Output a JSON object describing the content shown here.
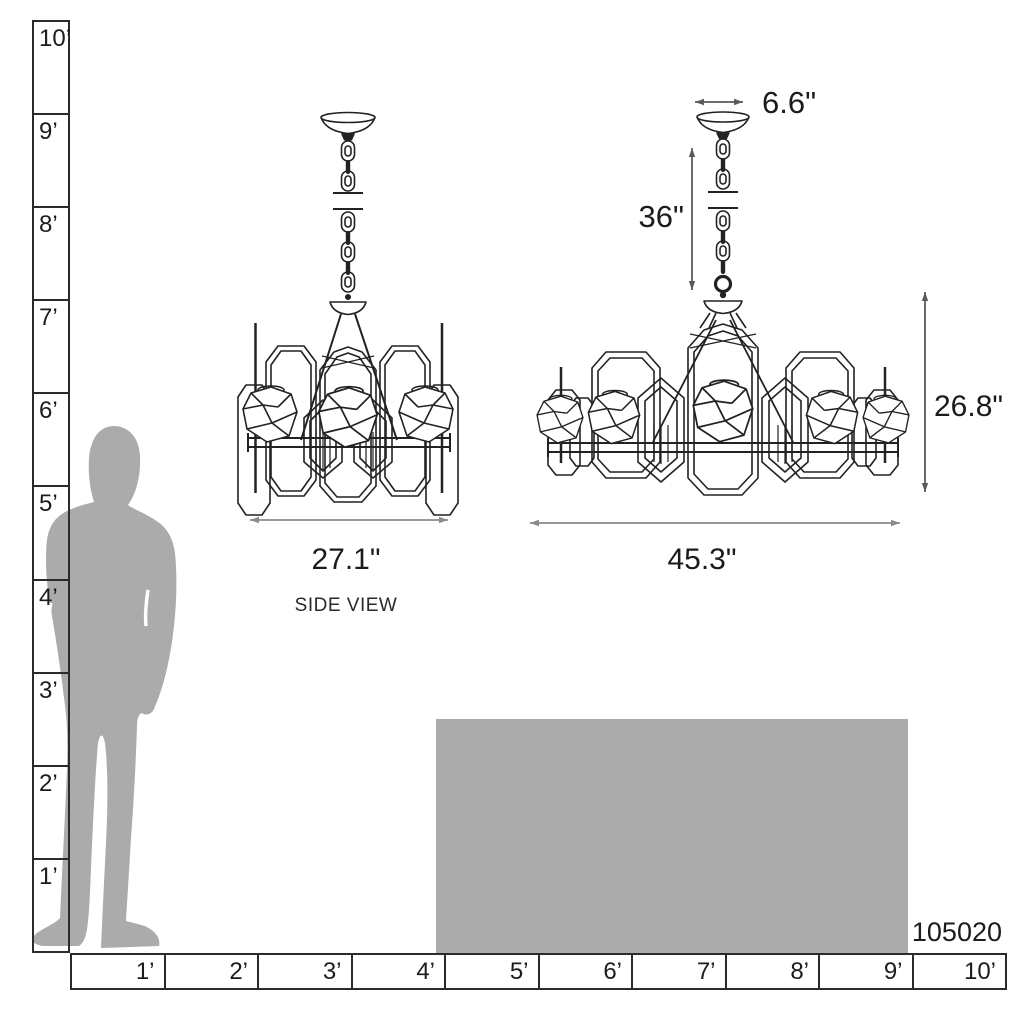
{
  "title": "Chandelier dimension diagram",
  "product_code": "105020",
  "vertical_ruler": {
    "labels": [
      "10’",
      "9’",
      "8’",
      "7’",
      "6’",
      "5’",
      "4’",
      "3’",
      "2’",
      "1’"
    ]
  },
  "horizontal_ruler": {
    "labels": [
      "1’",
      "2’",
      "3’",
      "4’",
      "5’",
      "6’",
      "7’",
      "8’",
      "9’",
      "10’"
    ]
  },
  "side_view": {
    "width": "27.1\"",
    "caption": "SIDE VIEW"
  },
  "front_view": {
    "canopy_width": "6.6\"",
    "chain_length": "36\"",
    "fixture_height": "26.8\"",
    "fixture_width": "45.3\""
  },
  "colors": {
    "line": "#222222",
    "dim_arrow": "#8a8a8a",
    "dim_arrow_dark": "#5a5a5a",
    "silhouette": "#ababab",
    "block": "#ababab",
    "ruler_border": "#2b2b2b",
    "text": "#1c1c1c"
  }
}
